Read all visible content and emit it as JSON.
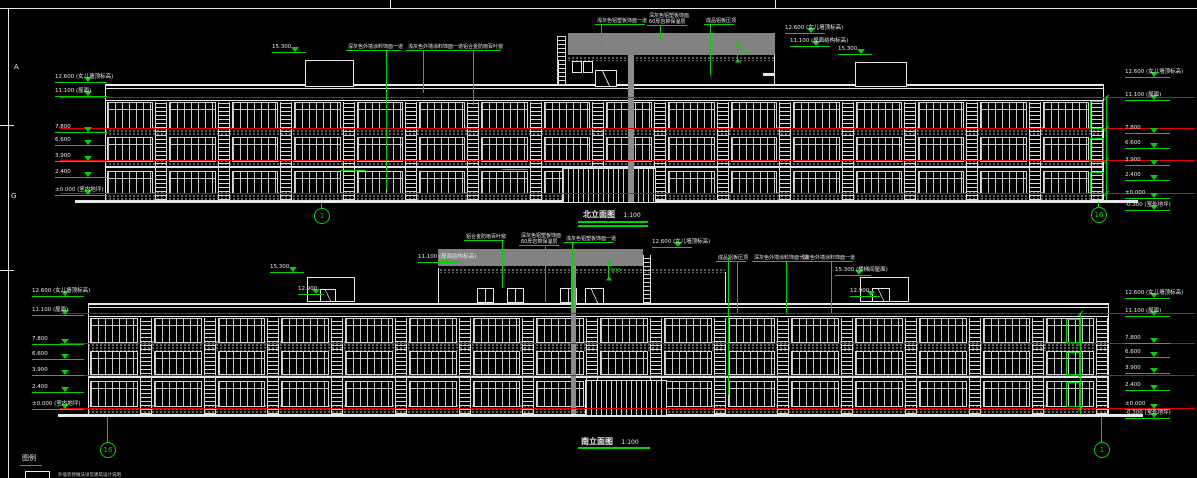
{
  "colors": {
    "background": "#000000",
    "drawing_line": "#e8e8e8",
    "level_line_red": "#e60000",
    "annotation_green": "#00d400",
    "roof_band_gray": "#828282"
  },
  "frame": {
    "zone_top": "A",
    "zone_bottom": "G"
  },
  "legend": {
    "title": "图例",
    "note": "外墙装修做法详见建筑设计说明"
  },
  "north": {
    "title": "北立面图",
    "scale": "1:100",
    "bubble_left": "1",
    "bubble_right": "16",
    "levels_left": [
      {
        "value": "12.600",
        "label": "(女儿墙顶标高)"
      },
      {
        "value": "11.100",
        "label": "(屋面)"
      },
      {
        "value": "7.800",
        "label": ""
      },
      {
        "value": "6.600",
        "label": ""
      },
      {
        "value": "3.900",
        "label": ""
      },
      {
        "value": "2.400",
        "label": ""
      },
      {
        "value": "±0.000",
        "label": "(室内地坪)"
      }
    ],
    "levels_right": [
      {
        "value": "12.600",
        "label": "(女儿墙顶标高)"
      },
      {
        "value": "11.100",
        "label": "(屋面)"
      },
      {
        "value": "7.800",
        "label": ""
      },
      {
        "value": "6.600",
        "label": ""
      },
      {
        "value": "3.900",
        "label": ""
      },
      {
        "value": "2.400",
        "label": ""
      },
      {
        "value": "±0.000",
        "label": ""
      },
      {
        "value": "-0.300",
        "label": "(室外地坪)"
      }
    ],
    "roof_marks": [
      {
        "value": "15.300",
        "label": ""
      },
      {
        "value": "15.300",
        "label": ""
      },
      {
        "value": "12.600",
        "label": "(女儿墙顶标高)"
      },
      {
        "value": "11.100",
        "label": "(屋面结构标高)"
      }
    ],
    "annotations_left": [
      {
        "text": "深灰色外墙涂料饰面一道"
      },
      {
        "text": "浅灰色外墙涂料饰面一道"
      },
      {
        "text": "铝合金防雨百叶窗"
      }
    ],
    "annotations_center": [
      {
        "text": "浅灰色铝塑板饰面一道"
      },
      {
        "text": "深灰色铝塑板饰面",
        "text2": "60厚岩棉保温层"
      },
      {
        "text": "成品铝板压顶"
      }
    ],
    "dim_label": "600"
  },
  "south": {
    "title": "南立面图",
    "scale": "1:100",
    "bubble_left": "16",
    "bubble_right": "1",
    "levels_left": [
      {
        "value": "12.600",
        "label": "(女儿墙顶标高)"
      },
      {
        "value": "11.100",
        "label": "(屋面)"
      },
      {
        "value": "7.800",
        "label": ""
      },
      {
        "value": "6.600",
        "label": ""
      },
      {
        "value": "3.900",
        "label": ""
      },
      {
        "value": "2.400",
        "label": ""
      },
      {
        "value": "±0.000",
        "label": "(室内地坪)"
      }
    ],
    "levels_right": [
      {
        "value": "12.600",
        "label": "(女儿墙顶标高)"
      },
      {
        "value": "11.100",
        "label": "(屋面)"
      },
      {
        "value": "7.800",
        "label": ""
      },
      {
        "value": "6.600",
        "label": ""
      },
      {
        "value": "3.900",
        "label": ""
      },
      {
        "value": "2.400",
        "label": ""
      },
      {
        "value": "±0.000",
        "label": ""
      },
      {
        "value": "-0.300",
        "label": "(室外地坪)"
      }
    ],
    "roof_marks": [
      {
        "value": "12.600",
        "label": "(女儿墙顶标高)"
      },
      {
        "value": "11.100",
        "label": "(屋面结构标高)"
      },
      {
        "value": "15.300",
        "label": "(楼梯间屋面)"
      },
      {
        "value": "12.900",
        "label": ""
      },
      {
        "value": "15.300",
        "label": ""
      },
      {
        "value": "12.900",
        "label": ""
      }
    ],
    "annotations_a": [
      {
        "text": "铝合金防雨百叶窗"
      },
      {
        "text": "深灰色铝塑板饰面",
        "text2": "60厚岩棉保温层"
      },
      {
        "text": "浅灰色铝塑板饰面一道"
      }
    ],
    "annotations_b": [
      {
        "text": "成品铝板压顶"
      },
      {
        "text": "深灰色外墙涂料饰面一道"
      },
      {
        "text": "浅灰色外墙涂料饰面一道"
      }
    ],
    "dim_label": "600"
  }
}
